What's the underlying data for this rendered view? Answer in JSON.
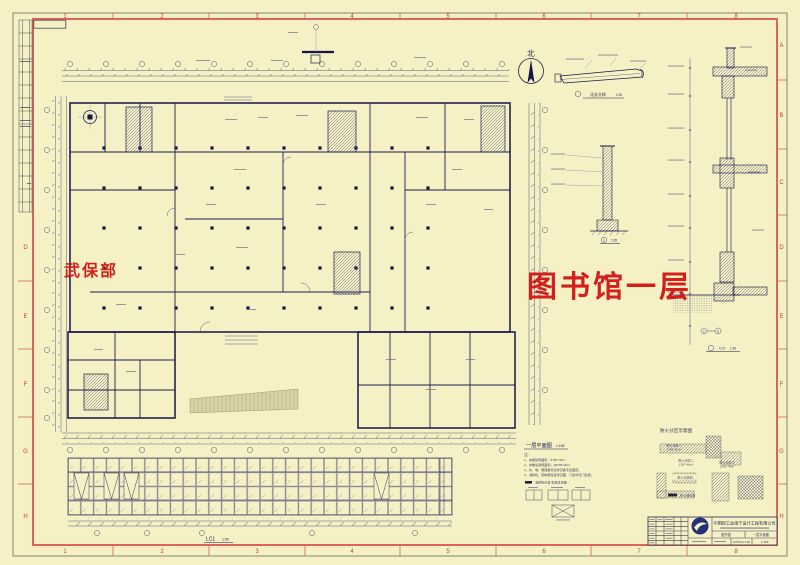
{
  "colors": {
    "paper": "#f6f1c4",
    "frame_red": "#e0625e",
    "ref_red": "#c04040",
    "ink": "#15154a",
    "watermark_red": "#d31414"
  },
  "margin_refs": {
    "top": [
      "1",
      "2",
      "3",
      "4",
      "5",
      "6",
      "7",
      "8"
    ],
    "bottom": [
      "1",
      "2",
      "3",
      "4",
      "5",
      "6",
      "7",
      "8"
    ],
    "right": [
      "A",
      "B",
      "C",
      "D",
      "E",
      "F",
      "G",
      "H"
    ],
    "left": [
      "D",
      "E",
      "F",
      "G",
      "H"
    ]
  },
  "watermarks": {
    "department": "武保部",
    "drawing": "图书馆一层"
  },
  "plan": {
    "north": "北",
    "title": "一层平面图",
    "scale": "1:150"
  },
  "notes": {
    "heading": "注:",
    "lines": [
      "1、本层建筑面积：5756.79m²",
      "2、本楼总建筑面积：26795.29m²",
      "3、水、电、暖通各管道详见各专业图纸。",
      "4、消防栓、配电箱位置详见图，门窗详见门窗表。"
    ],
    "legend": "消防栓位置  安装详见图"
  },
  "fire_diagram": {
    "title": "防火分区示意图",
    "zones": [
      {
        "label": "防火分区一",
        "area": "1249.32m²"
      },
      {
        "label": "防火分区二",
        "area": "1337.46m²"
      },
      {
        "label": "防火分区三",
        "area": "1141.79m²"
      },
      {
        "label": "防火分区四",
        "area": ""
      }
    ],
    "legend": "防火墙位置"
  },
  "window_elevation": {
    "label": "LC1",
    "scale": "1:50"
  },
  "details": [
    {
      "label": "泛水大样",
      "scale": "1:20"
    },
    {
      "label": "3",
      "scale": "1:20"
    },
    {
      "label": "C-D",
      "scale": "1:20",
      "marks": [
        "C",
        "D"
      ]
    }
  ],
  "title_block": {
    "company": "中国轻工业南宁设计工程有限公司",
    "project": "图书馆",
    "drawing_title": "一层平面图",
    "drawing_no": "W757SJ-1-05",
    "scale": "1:150"
  }
}
